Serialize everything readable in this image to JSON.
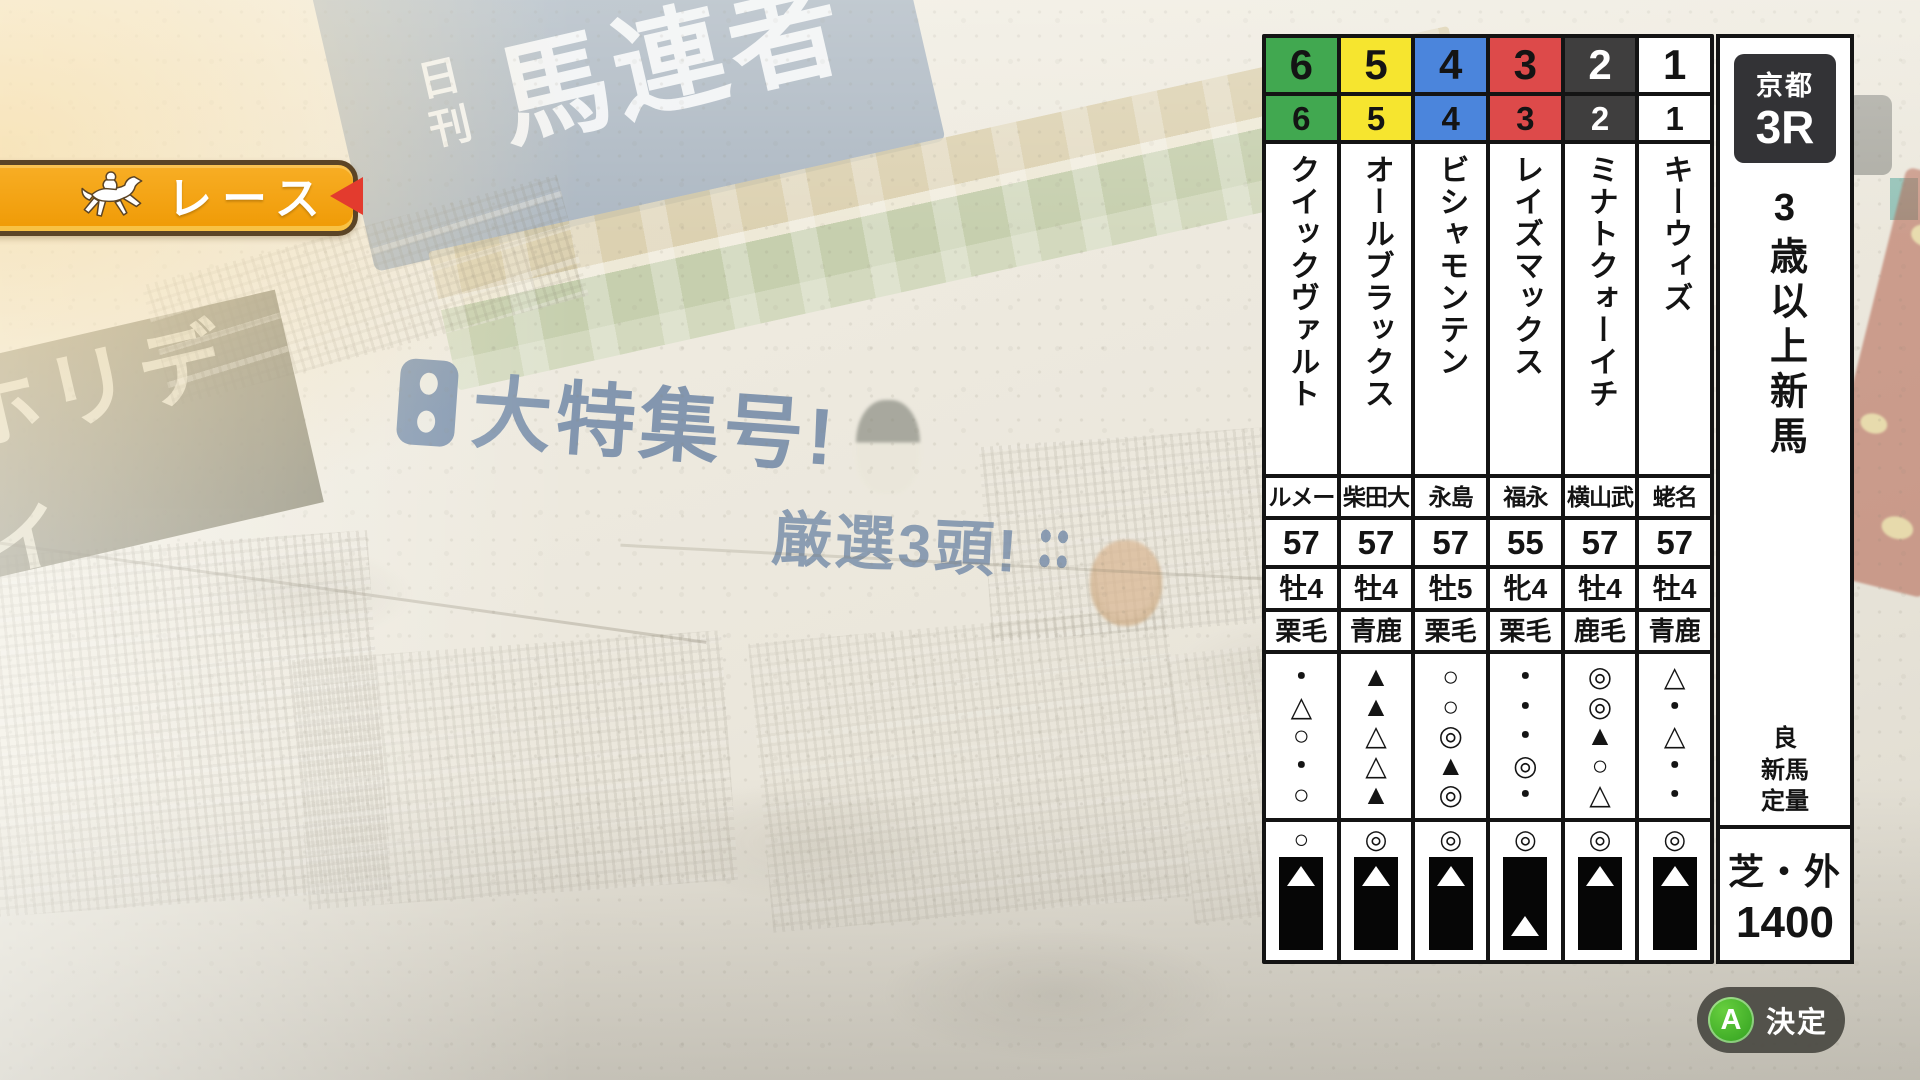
{
  "race_banner": {
    "label": "レース"
  },
  "race_info": {
    "track": "京都",
    "race_number": "3R",
    "conditions": "3歳以上新馬",
    "going": "良",
    "race_class": "新馬",
    "weight_rule": "定量",
    "surface": "芝・外",
    "distance": "1400"
  },
  "horses": [
    {
      "frame": "6",
      "number": "6",
      "name": "クイックヴァルト",
      "jockey": "ルメー",
      "weight": "57",
      "sex_age": "牡4",
      "coat": "栗毛",
      "marks": [
        "・",
        "△",
        "○",
        "・",
        "○"
      ],
      "final_mark": "○",
      "bar_triangle": "top",
      "frame_color": "#41a850",
      "number_text_color": "#141414"
    },
    {
      "frame": "5",
      "number": "5",
      "name": "オールブラックス",
      "jockey": "柴田大",
      "weight": "57",
      "sex_age": "牡4",
      "coat": "青鹿",
      "marks": [
        "▲",
        "▲",
        "△",
        "△",
        "▲"
      ],
      "final_mark": "◎",
      "bar_triangle": "top",
      "frame_color": "#f6e52f",
      "number_text_color": "#141414"
    },
    {
      "frame": "4",
      "number": "4",
      "name": "ビシャモンテン",
      "jockey": "永島",
      "weight": "57",
      "sex_age": "牡5",
      "coat": "栗毛",
      "marks": [
        "○",
        "○",
        "◎",
        "▲",
        "◎"
      ],
      "final_mark": "◎",
      "bar_triangle": "top",
      "frame_color": "#4b85dc",
      "number_text_color": "#141414"
    },
    {
      "frame": "3",
      "number": "3",
      "name": "レイズマックス",
      "jockey": "福永",
      "weight": "55",
      "sex_age": "牝4",
      "coat": "栗毛",
      "marks": [
        "・",
        "・",
        "・",
        "◎",
        "・"
      ],
      "final_mark": "◎",
      "bar_triangle": "bottom",
      "frame_color": "#dd4a4a",
      "number_text_color": "#141414"
    },
    {
      "frame": "2",
      "number": "2",
      "name": "ミナトクォーイチ",
      "jockey": "横山武",
      "weight": "57",
      "sex_age": "牡4",
      "coat": "鹿毛",
      "marks": [
        "◎",
        "◎",
        "▲",
        "○",
        "△"
      ],
      "final_mark": "◎",
      "bar_triangle": "top",
      "frame_color": "#3f3e3e",
      "number_text_color": "#ffffff"
    },
    {
      "frame": "1",
      "number": "1",
      "name": "キーウィズ",
      "jockey": "蛯名",
      "weight": "57",
      "sex_age": "牡4",
      "coat": "青鹿",
      "marks": [
        "△",
        "・",
        "△",
        "・",
        "・"
      ],
      "final_mark": "◎",
      "bar_triangle": "top",
      "frame_color": "#ffffff",
      "number_text_color": "#141414"
    }
  ],
  "confirm_button": {
    "button_key": "A",
    "label": "決定"
  },
  "newspaper": {
    "masthead_prefix": "日刊",
    "masthead_title": "馬連者",
    "side_title": "ホリディ",
    "headline_main": "大特集号!",
    "headline_sub": "厳選3頭!"
  },
  "colors": {
    "banner_orange": "#f2a115",
    "banner_border": "#5b4426",
    "arrow_red": "#e33b2e",
    "button_green": "#3fae27",
    "pill_gray": "#4a4943",
    "headline_blue": "#7b90ab"
  }
}
